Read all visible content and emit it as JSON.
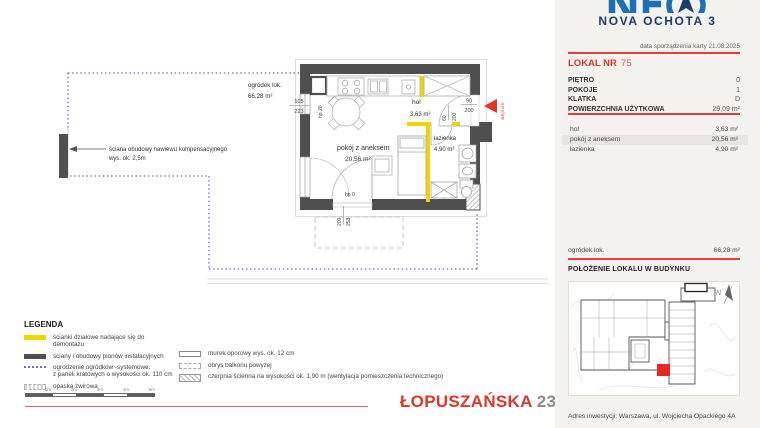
{
  "colors": {
    "accent_red": "#e0352b",
    "light_red": "#e2655e",
    "wall_gray": "#4f4f4f",
    "demo_yellow": "#f2d500",
    "fence_blue": "#6b6bd6",
    "navy": "#1d3c6b",
    "logo_blue": "#1d6fb5",
    "panel_bg": "#f4f2ef",
    "row_highlight": "#e7e5e2"
  },
  "plan": {
    "garden_label": "ogródek lok.",
    "garden_area": "66,28 m²",
    "wall_note_line1": "ściana obudowy nawiewu kompensacyjnego",
    "wall_note_line2": "wys. ok. 2,5m",
    "entrance_label": "wejście",
    "rooms": {
      "pokoj": {
        "name": "pokój z aneksem",
        "area": "20,56 m²"
      },
      "hol": {
        "name": "hol",
        "area": "3,63 m²"
      },
      "lazienka": {
        "name": "łazienka",
        "area": "4,90 m²"
      }
    },
    "dims": {
      "left_window_w": "105",
      "left_window_h": "223",
      "left_window_hp": "hp 20",
      "entry_w": "90",
      "entry_h": "200",
      "bath_door_w": "60",
      "bath_door_h": "200",
      "balcony_hp": "hp 0",
      "balcony_w": "200",
      "balcony_h": "253"
    }
  },
  "legend": {
    "title": "LEGENDA",
    "left": [
      {
        "label": "ścianki działowe nadające się do demontażu",
        "label2": ""
      },
      {
        "label": "ściany i obudowy pionów instalacyjnych",
        "label2": ""
      },
      {
        "label": "ogrodzenie ogródków -systemowe,",
        "label2": "z paneli kratowych o wysokości ok. 110 cm"
      },
      {
        "label": "opaska żwirowa",
        "label2": ""
      }
    ],
    "right": [
      {
        "label": "murek oporowy wys. ok. 12 cm"
      },
      {
        "label": "obrys balkonu powyżej"
      },
      {
        "label": "czerpnia ścienna na wysokości ok. 1,90 m (wentylacja pomieszczenia technicznego)"
      }
    ]
  },
  "scalebar": {
    "labels": [
      "1m",
      "2m",
      "3m",
      "4m",
      "5m"
    ]
  },
  "brand": {
    "street": "ŁOPUSZAŃSKA",
    "number": "235"
  },
  "panel": {
    "logo_text": "NEO",
    "project_name": "NOVA OCHOTA 3",
    "date_line": "data sporządzenia karty 21.08.2025",
    "lokal_label": "LOKAL NR",
    "lokal_number": "75",
    "attributes": [
      {
        "label": "PIĘTRO",
        "value": "0"
      },
      {
        "label": "POKOJE",
        "value": "1"
      },
      {
        "label": "KLATKA",
        "value": "D"
      },
      {
        "label": "POWIERZCHNIA UŻYTKOWA",
        "value": "29,09 m²"
      }
    ],
    "rooms": [
      {
        "label": "hol",
        "value": "3,63 m²"
      },
      {
        "label": "pokój z aneksem",
        "value": "20,56 m²"
      },
      {
        "label": "łazienka",
        "value": "4,90 m²"
      }
    ],
    "garden": {
      "label": "ogródek lok.",
      "value": "66,28 m²"
    },
    "location_heading": "POŁOŻENIE LOKALU W BUDYNKU",
    "north_label": "N",
    "address": "Adres inwestycji: Warszawa, ul. Wojciecha Opackiego 4A"
  }
}
